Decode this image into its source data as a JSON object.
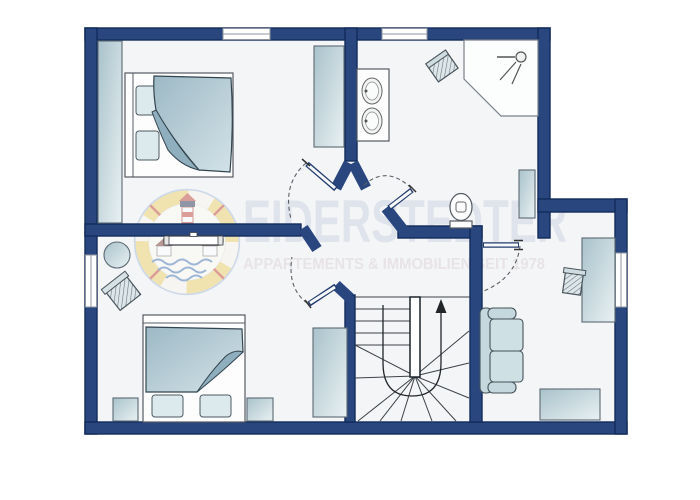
{
  "watermark": {
    "brand": "EIDERSTEDTER",
    "tagline": "APPARTEMENTS & IMMOBILIEN SEIT 1978"
  },
  "palette": {
    "wall": "#29467f",
    "wall_outline": "#122b5a",
    "floor": "#f4f5f7",
    "furniture_fill": "#cfe0e6",
    "furniture_outline": "#5b6a74",
    "blanket": "#aac3cf",
    "watermark_title_color": "#dfe3eb",
    "watermark_tagline_color": "#e7e3e7",
    "logo_yellow": "#f0d36b",
    "logo_red": "#c4483c",
    "logo_blue": "#4a79b5",
    "door_arc": "#5a5f66"
  },
  "floor_plan": {
    "rooms": [
      {
        "name": "bedroom-top-left",
        "furniture": [
          "closet-strip",
          "wardrobe",
          "double-bed",
          "pillows",
          "blanket"
        ]
      },
      {
        "name": "bathroom-top-right",
        "furniture": [
          "double-sink-vanity",
          "laundry-stool",
          "corner-shower",
          "shower-head",
          "radiator",
          "toilet"
        ]
      },
      {
        "name": "bedroom-bottom-left",
        "furniture": [
          "round-table",
          "armchair",
          "radiator",
          "wardrobe",
          "double-bed",
          "nightstand-left",
          "nightstand-right"
        ]
      },
      {
        "name": "study-right",
        "furniture": [
          "sofa",
          "desk",
          "desk-chair",
          "sideboard"
        ]
      },
      {
        "name": "hallway-center",
        "furniture": []
      }
    ],
    "stairs": {
      "type": "u-shaped-winder",
      "direction": "up"
    },
    "door_count": 4,
    "window_count": 4
  }
}
